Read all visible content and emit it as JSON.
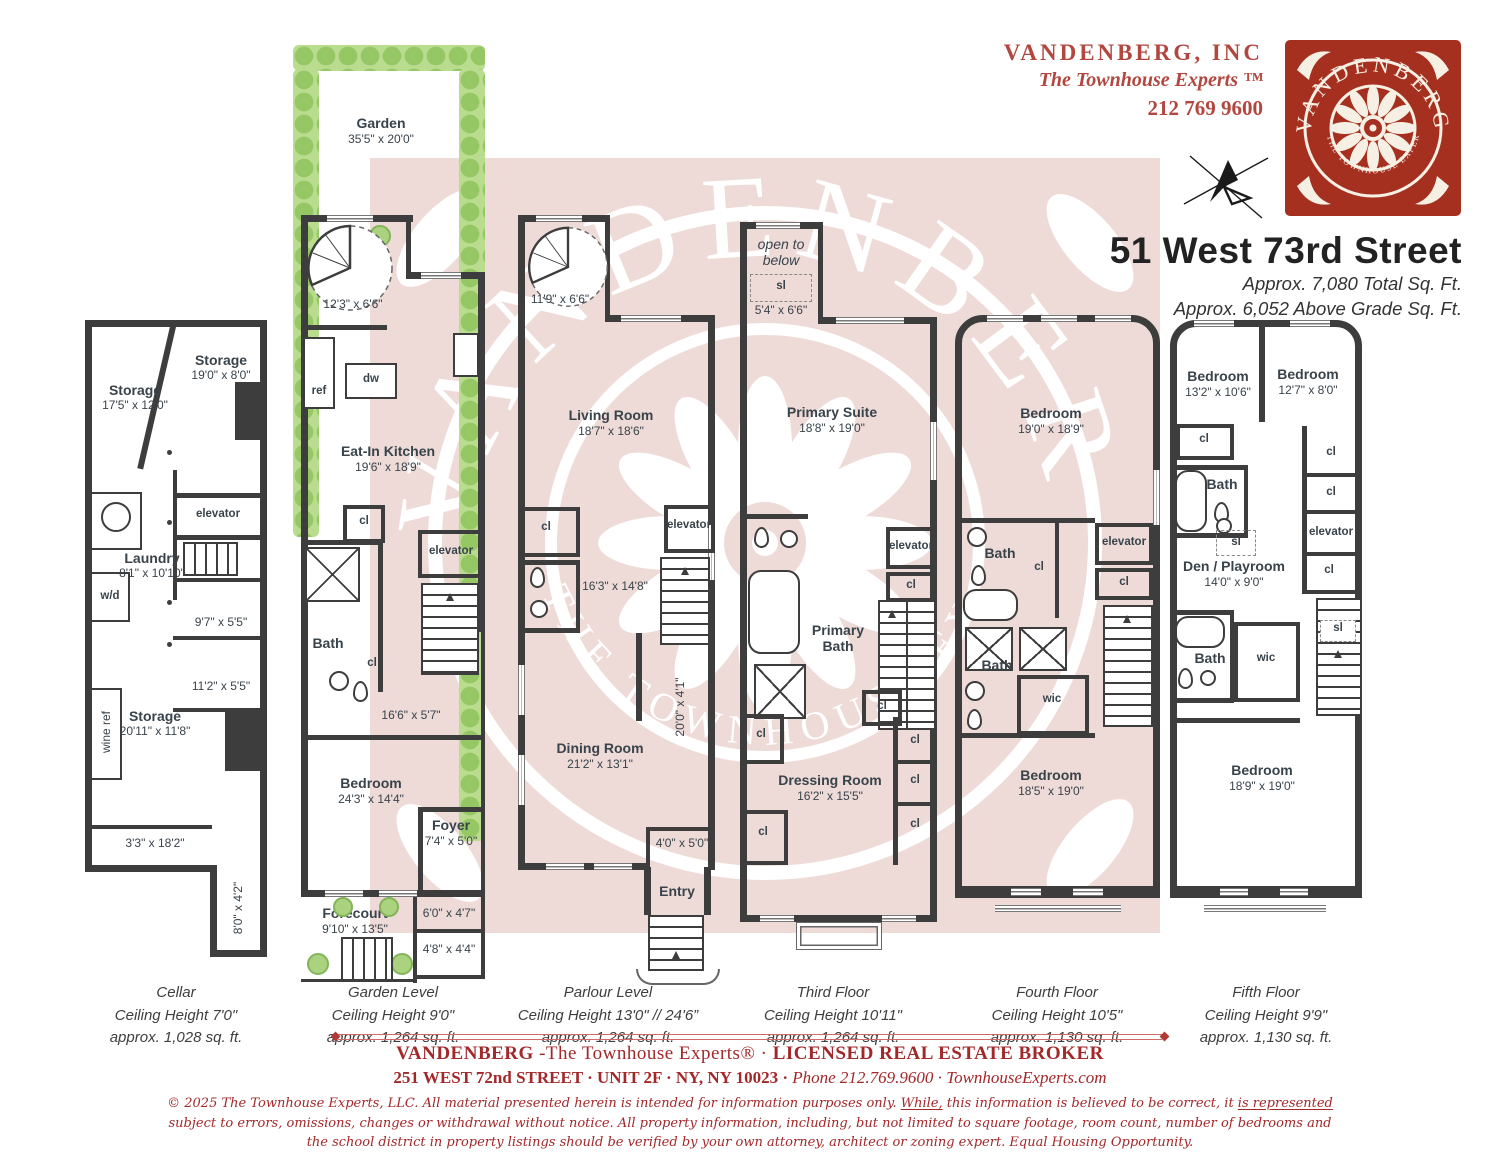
{
  "header": {
    "company": "VANDENBERG, INC",
    "tagline": "The Townhouse Experts ™",
    "phone": "212 769 9600",
    "address": "51 West 73rd Street",
    "total": "Approx. 7,080 Total Sq. Ft.",
    "above_grade": "Approx. 6,052 Above Grade Sq. Ft.",
    "logo_outer": "VANDENBERG",
    "logo_inner": "THE TOWNHOUSE EXPERTS",
    "brand_red": "#a5301f"
  },
  "watermark": {
    "outer": "VANDENBERG",
    "inner": "THE TOWNHOUSE EXPERTS"
  },
  "floors": [
    {
      "id": "cellar",
      "level": "Cellar",
      "ceiling": "Ceiling Height 7'0\"",
      "area": "approx. 1,028 sq. ft.",
      "rooms": [
        {
          "label": "Storage",
          "dims": "17'5\" x 12'0\""
        },
        {
          "label": "Storage",
          "dims": "19'0\" x 8'0\""
        },
        {
          "label": "elevator"
        },
        {
          "label": "Laundry",
          "dims": "8'1\" x 10'10\""
        },
        {
          "label": "w/d"
        },
        {
          "dims": "9'7\" x 5'5\""
        },
        {
          "dims": "11'2\" x 5'5\""
        },
        {
          "label": "wine ref"
        },
        {
          "label": "Storage",
          "dims": "20'11\" x 11'8\""
        },
        {
          "dims": "3'3\" x 18'2\""
        },
        {
          "dims": "8'0\" x 4'2\""
        }
      ]
    },
    {
      "id": "garden",
      "level": "Garden Level",
      "ceiling": "Ceiling Height 9'0\"",
      "area": "approx. 1,264 sq. ft.",
      "rooms": [
        {
          "label": "Garden",
          "dims": "35'5\" x 20'0\""
        },
        {
          "dims": "12'3\" x 6'6\""
        },
        {
          "label": "ref"
        },
        {
          "label": "dw"
        },
        {
          "label": "Eat-In Kitchen",
          "dims": "19'6\" x 18'9\""
        },
        {
          "label": "cl"
        },
        {
          "label": "elevator"
        },
        {
          "label": "Bath"
        },
        {
          "label": "cl"
        },
        {
          "dims": "16'6\" x 5'7\""
        },
        {
          "label": "Bedroom",
          "dims": "24'3\" x 14'4\""
        },
        {
          "label": "Foyer",
          "dims": "7'4\" x 5'0\""
        },
        {
          "dims": "6'0\" x 4'7\""
        },
        {
          "label": "Forecourt",
          "dims": "9'10\" x 13'5\""
        },
        {
          "dims": "4'8\" x 4'4\""
        }
      ]
    },
    {
      "id": "parlour",
      "level": "Parlour Level",
      "ceiling": "Ceiling Height 13'0\" //  24'6”",
      "area": "approx. 1,264 sq. ft.",
      "rooms": [
        {
          "dims": "11'9\" x 6'6\""
        },
        {
          "label": "Living Room",
          "dims": "18'7\" x 18'6\""
        },
        {
          "label": "cl"
        },
        {
          "label": "elevator"
        },
        {
          "dims": "16'3\" x 14'8\""
        },
        {
          "dims": "20'0\" x 4'1\""
        },
        {
          "label": "Dining Room",
          "dims": "21'2\" x 13'1\""
        },
        {
          "dims": "4'0\" x 5'0\""
        },
        {
          "label": "Entry"
        }
      ]
    },
    {
      "id": "third",
      "level": "Third Floor",
      "ceiling": "Ceiling Height 10'11\"",
      "area": "approx. 1,264 sq. ft.",
      "rooms": [
        {
          "label": "open to below"
        },
        {
          "label": "sl"
        },
        {
          "dims": "5'4\" x 6'6\""
        },
        {
          "label": "Primary Suite",
          "dims": "18'8\" x 19'0\""
        },
        {
          "label": "elevator"
        },
        {
          "label": "cl"
        },
        {
          "label": "Primary Bath"
        },
        {
          "label": "cl"
        },
        {
          "label": "cl"
        },
        {
          "label": "cl"
        },
        {
          "label": "Dressing Room",
          "dims": "16'2\" x 15'5\""
        },
        {
          "label": "cl"
        },
        {
          "label": "cl"
        },
        {
          "label": "cl"
        }
      ]
    },
    {
      "id": "fourth",
      "level": "Fourth Floor",
      "ceiling": "Ceiling Height 10'5\"",
      "area": "approx. 1,130 sq. ft.",
      "rooms": [
        {
          "label": "Bedroom",
          "dims": "19'0\" x 18'9\""
        },
        {
          "label": "Bath"
        },
        {
          "label": "cl"
        },
        {
          "label": "elevator"
        },
        {
          "label": "cl"
        },
        {
          "label": "Bath"
        },
        {
          "label": "wic"
        },
        {
          "label": "Bedroom",
          "dims": "18'5\" x 19'0\""
        }
      ]
    },
    {
      "id": "fifth",
      "level": "Fifth Floor",
      "ceiling": "Ceiling Height 9'9\"",
      "area": "approx. 1,130 sq. ft.",
      "rooms": [
        {
          "label": "Bedroom",
          "dims": "13'2\" x 10'6\""
        },
        {
          "label": "Bedroom",
          "dims": "12'7\" x 8'0\""
        },
        {
          "label": "cl"
        },
        {
          "label": "Bath"
        },
        {
          "label": "cl"
        },
        {
          "label": "cl"
        },
        {
          "label": "elevator"
        },
        {
          "label": "cl"
        },
        {
          "label": "sl"
        },
        {
          "label": "Den / Playroom",
          "dims": "14'0\" x 9'0\""
        },
        {
          "label": "Bath"
        },
        {
          "label": "wic"
        },
        {
          "label": "sl"
        },
        {
          "label": "Bedroom",
          "dims": "18'9\" x 19'0\""
        }
      ]
    }
  ],
  "footer": {
    "brand": "VANDENBERG",
    "brand_rest": " -The Townhouse Experts®  ·  ",
    "broker": "LICENSED REAL ESTATE BROKER",
    "address": "251 WEST 72nd STREET  ·  UNIT 2F  ·  NY, NY 10023  ·  ",
    "phone": "Phone 212.769.9600  ·  ",
    "site": "TownhouseExperts.com",
    "disc1": "© 2025 The Townhouse Experts, LLC. All material presented herein is intended for information purposes only. ",
    "disc2": "While,",
    "disc3": " this information is believed to be correct, it ",
    "disc4": "is represented",
    "disc5": " subject to errors, omissions, changes or withdrawal without notice. All property information, including, but not limited to square footage, room count, number of bedrooms and the school district in property listings should be verified by your own attorney, architect or zoning expert. Equal Housing Opportunity."
  }
}
